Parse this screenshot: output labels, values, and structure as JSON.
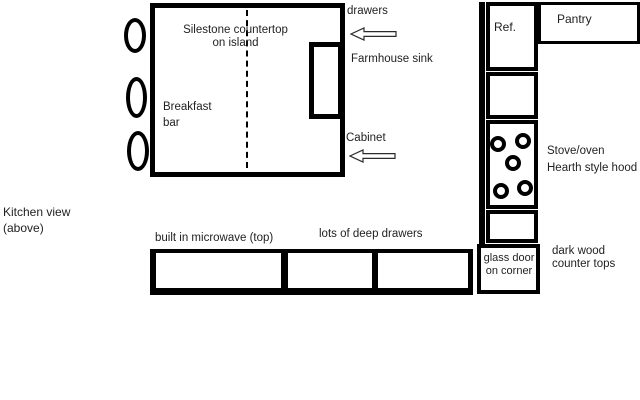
{
  "colors": {
    "ink": "#000000",
    "paper": "#ffffff",
    "text": "#1f1f1f"
  },
  "caption": {
    "line1": "Kitchen view",
    "line2": "(above)"
  },
  "island": {
    "label_line1": "Silestone countertop",
    "label_line2": "on island",
    "breakfast_line1": "Breakfast",
    "breakfast_line2": "bar",
    "stool_count": 3
  },
  "annotations": {
    "drawers": "drawers",
    "farmhouse_sink": "Farmhouse sink",
    "cabinet": "Cabinet",
    "microwave": "built in microwave (top)",
    "deep_drawers": "lots of deep drawers",
    "stove_line1": "Stove/oven",
    "stove_line2": "Hearth style hood",
    "dark_wood_line1": "dark wood",
    "dark_wood_line2": "counter tops"
  },
  "right_wall": {
    "ref": "Ref.",
    "pantry": "Pantry",
    "glass_door_line1": "glass door",
    "glass_door_line2": "on corner",
    "burner_count": 5
  }
}
